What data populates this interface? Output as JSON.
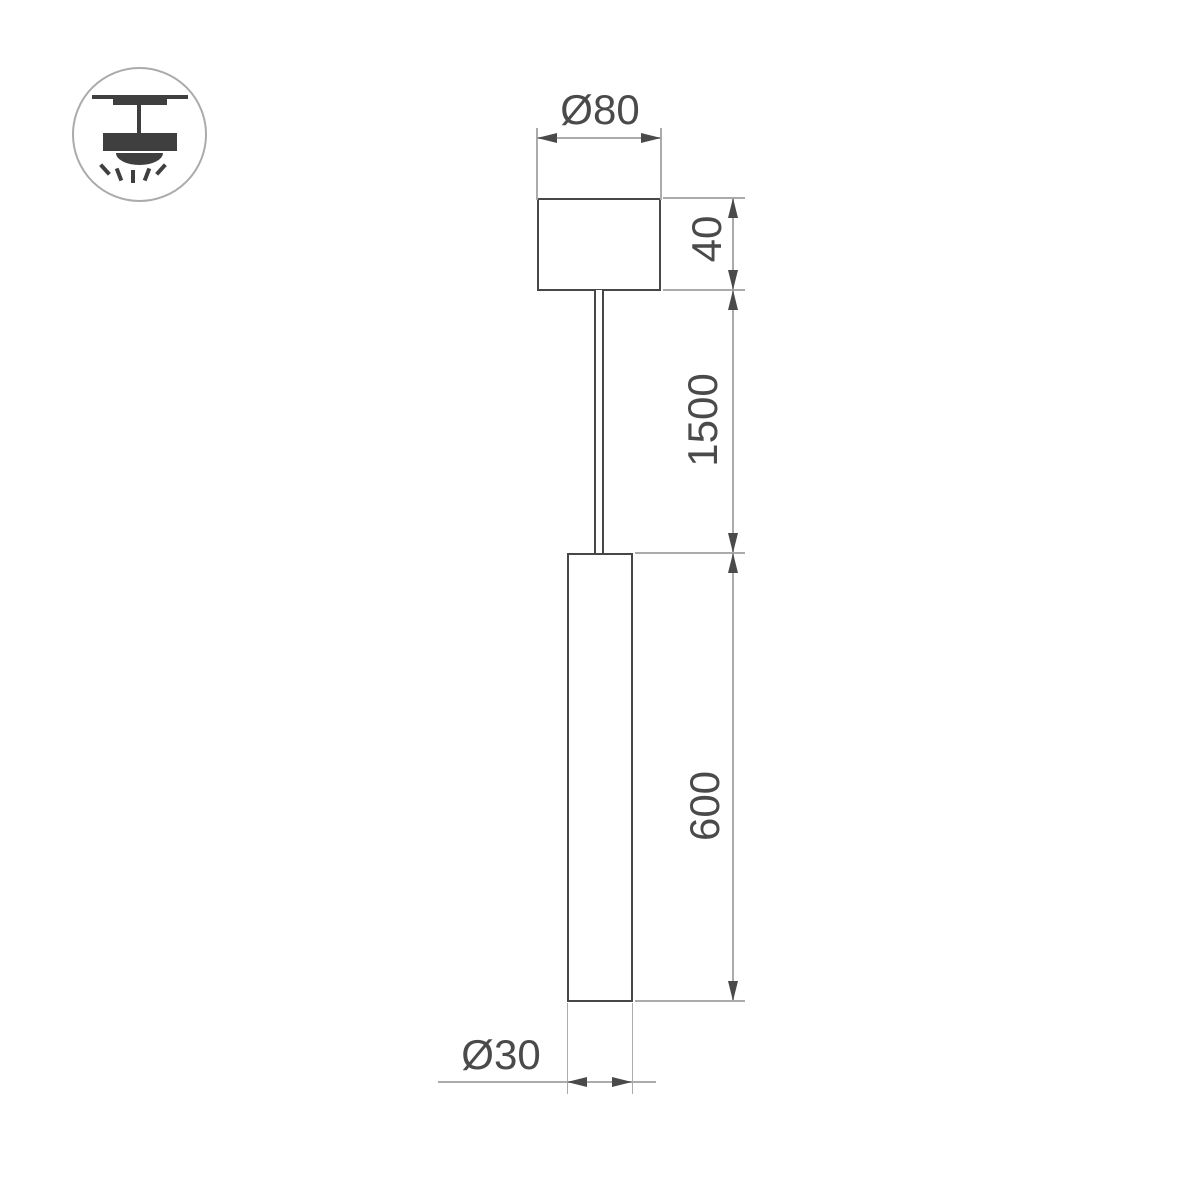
{
  "icon": {
    "name": "pendant-ceiling-mount",
    "description": "suspended pendant luminaire mounting pictogram"
  },
  "dimensions": {
    "canopy_diameter": "Ø80",
    "canopy_height": "40",
    "suspension_length": "1500",
    "body_length": "600",
    "body_diameter": "Ø30"
  },
  "colors": {
    "outline_dark": "#474747",
    "icon_dark": "#3f3f3f",
    "dimension_line": "#ababab",
    "text": "#4a4a4a",
    "background": "#ffffff"
  }
}
